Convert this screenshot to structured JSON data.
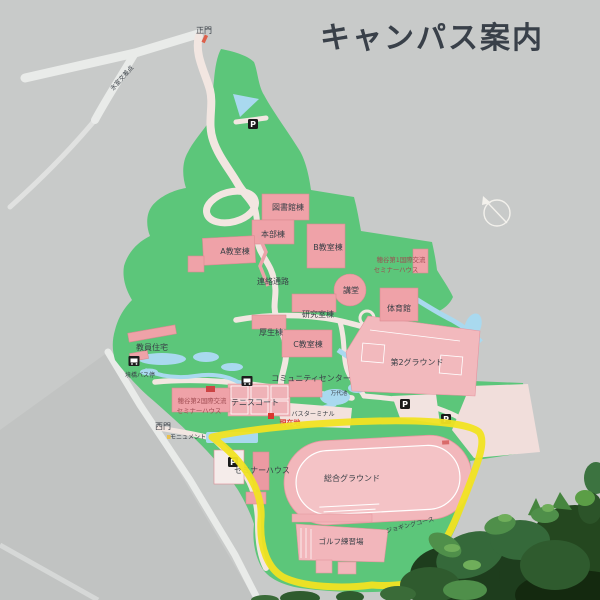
{
  "sign": {
    "title": "キャンパス案内",
    "labels": {
      "main_gate": "正門",
      "west_gate": "西門",
      "intersection": "氷室交差点",
      "bus_stop": "境橋バス停",
      "library": "図書館棟",
      "headquarters": "本部棟",
      "classroom_a": "A教室棟",
      "classroom_b": "B教室棟",
      "classroom_c": "C教室棟",
      "corridor": "連絡通路",
      "auditorium": "講堂",
      "seminar1_line1": "穂谷第1国際交流",
      "seminar1_line2": "セミナーハウス",
      "gymnasium": "体育館",
      "research": "研究室棟",
      "welfare": "厚生棟",
      "faculty_housing": "教員住宅",
      "community_center": "コミュニティセンター",
      "mandai_pond": "万代池",
      "ground2": "第2グラウンド",
      "seminar2_line1": "穂谷第2国際交流",
      "seminar2_line2": "セミナーハウス",
      "tennis_court": "テニスコート",
      "bus_terminal": "バスターミナル",
      "current_location": "現在地",
      "monument": "モニュメント",
      "seminar_house": "セミナーハウス",
      "main_ground": "総合グラウンド",
      "jogging_course": "ジョギングコース",
      "golf_range": "ゴルフ練習場",
      "parking": "P"
    },
    "colors": {
      "background_gray": "#c8cac9",
      "campus_green": "#5cc67a",
      "building_pink": "#efa2a8",
      "field_pink": "#f2b9bd",
      "water_blue": "#a9d9ef",
      "road_white": "#e9ebe9",
      "highlight_yellow": "#f1e322",
      "label_color": "#3a4047",
      "current_location_red": "#d9372e",
      "seminar_label_red": "#9e4a50"
    }
  }
}
